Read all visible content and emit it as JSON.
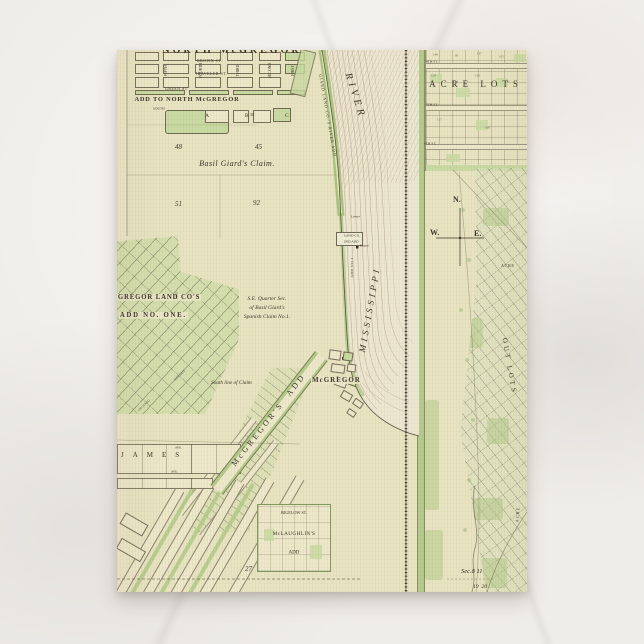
{
  "colors": {
    "bg": "#efede9",
    "paper": "#e8e4c2",
    "paper2": "#ece8c9",
    "green": "#c9daa2",
    "green2": "#b4cb8b",
    "ink": "#3c352a",
    "line": "#6b5d4a",
    "river": "#ede6d1",
    "rail": "#3a332b",
    "sand": "#a98b64"
  },
  "map": {
    "north": {
      "title": "NORTH McGREGOR",
      "add_label": "ADD TO NORTH McGREGOR",
      "block_letters": "A   B   C",
      "n36": "36",
      "streets": {
        "brown": "BROWN ST.",
        "traveler": "TRAVELER ST.",
        "green": "GREEN ST.",
        "south": "SOUTH",
        "fifth": "FIFTH",
        "fourth": "FOURTH",
        "third": "THIRD",
        "second": "SECOND",
        "first": "FIRST"
      }
    },
    "claim": {
      "name": "Basil Giard's Claim.",
      "n48": "48",
      "n45": "45",
      "n51": "51",
      "n92": "92"
    },
    "add_one": {
      "line1": "GREGOR LAND CO'S",
      "line2": "ADD NO. ONE.",
      "walnut": "WALNUT",
      "pine": "PINE",
      "orchard": "ORCHARD"
    },
    "quarter": {
      "l1": "S.E. Quarter Sec.",
      "l2": "of Basil Giard's",
      "l3": "Spanish Claim No.1.",
      "south_line": "South line of Claim"
    },
    "river": {
      "name_upper": "RIVER",
      "name_lower": "MISSISSIPPI",
      "shore_add": "GIARD LAND CO.'S RIVER ADD",
      "land_co_1": "LAND CO.",
      "land_co_2": "2ND ADD",
      "add_no1": "ADD NO.1",
      "lower": "Lower",
      "depot": "Depot"
    },
    "town": {
      "mcgregor": "McGREGOR",
      "mcgregors_add": "McGREGOR'S  ADD",
      "james": "JAMES",
      "ave1": "AVE.",
      "ave2": "AVE.",
      "bigelow": "BIGELOW ST.",
      "mclaughlin1": "McLAUGHLIN'S",
      "mclaughlin2": "ADD",
      "n27": "27"
    },
    "east": {
      "acre_lots": "ACRE LOTS",
      "s4": "4TH ST.",
      "s5": "5TH ST.",
      "s6": "6TH ST.",
      "acre_a": "ACRE",
      "acre_b": "ACRE",
      "out_lots": "OUT LOTS",
      "sec": "Sec.8 11",
      "sec_nums": "19  20",
      "lot_numbers": [
        "148",
        "95",
        "137",
        "105",
        "129",
        "134",
        "120",
        "141",
        "117",
        "108"
      ]
    },
    "compass": {
      "n": "N.",
      "w": "W.",
      "e": "E."
    }
  }
}
